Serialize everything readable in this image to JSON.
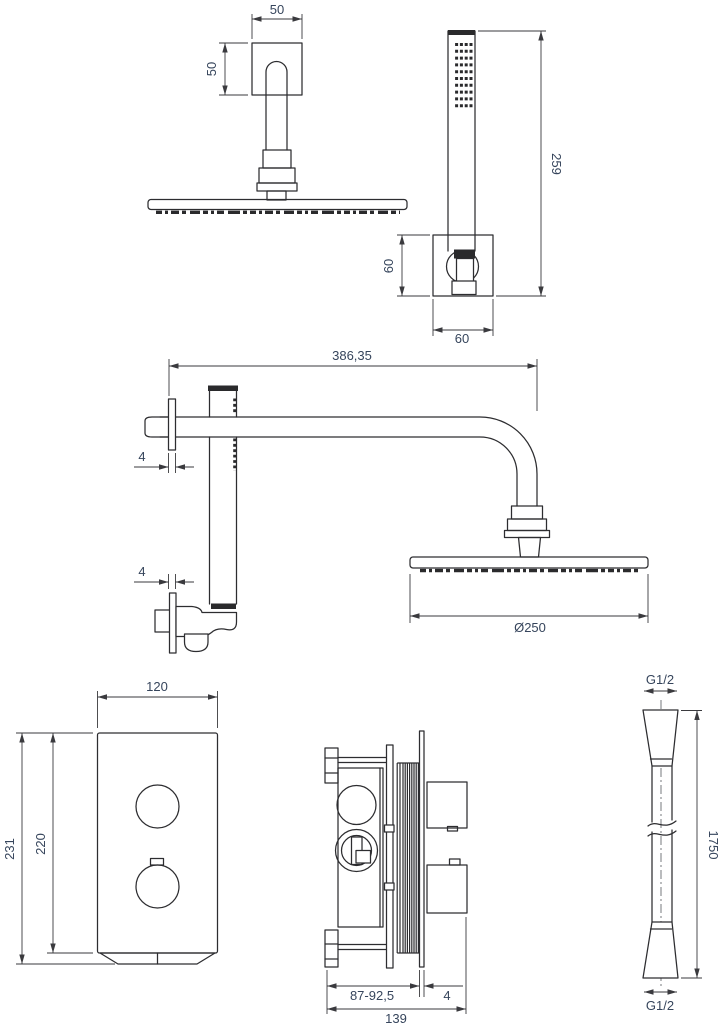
{
  "drawing": {
    "style": {
      "line_color": "#2d2d30",
      "dimension_line_color": "#3a3a3e",
      "dimension_text_color": "#36455c",
      "background": "#ffffff"
    },
    "views": {
      "ceiling_head": {
        "dims": {
          "plate_width": "50",
          "plate_height": "50"
        }
      },
      "hand_shower": {
        "dims": {
          "length": "259",
          "bracket_height": "60",
          "bracket_width": "60"
        }
      },
      "wall_arm": {
        "dims": {
          "arm_length": "386,35",
          "upper_flange_thickness": "4",
          "lower_flange_thickness": "4",
          "head_diameter": "Ø250"
        }
      },
      "valve_front": {
        "dims": {
          "width": "120",
          "total_height": "231",
          "plate_height": "220"
        }
      },
      "valve_side": {
        "dims": {
          "install_depth": "87-92,5",
          "plate_thickness": "4",
          "total_depth": "139"
        }
      },
      "hose": {
        "dims": {
          "top_thread": "G1/2",
          "length": "1750",
          "bottom_thread": "G1/2"
        }
      }
    }
  }
}
